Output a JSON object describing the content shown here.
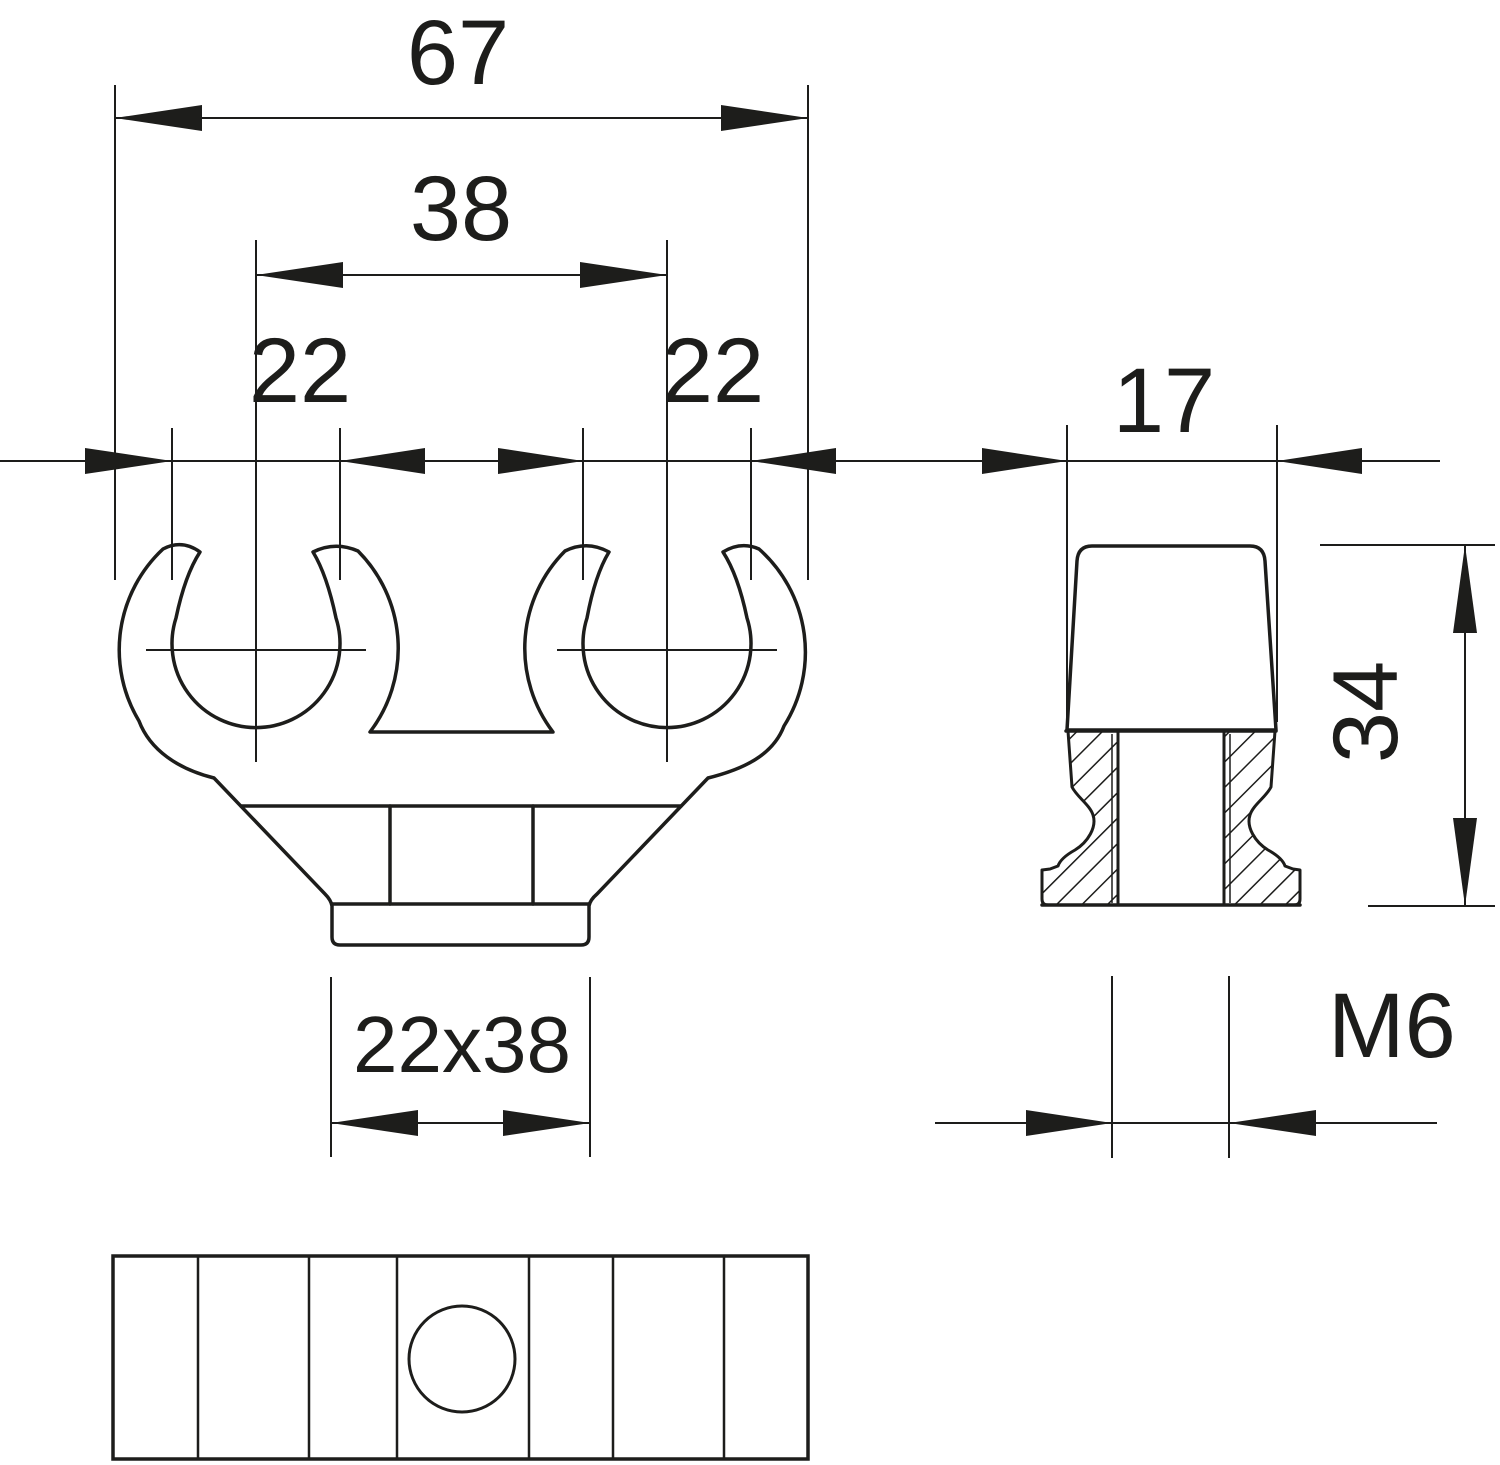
{
  "drawing": {
    "background_color": "#ffffff",
    "line_color": "#1d1d1b",
    "front_view": {
      "overall_width": "67",
      "center_distance": "38",
      "left_clip_bore": "22",
      "right_clip_bore": "22",
      "foot_size": "22x38"
    },
    "side_view": {
      "top_width": "17",
      "height": "34",
      "thread_size": "M6"
    }
  }
}
